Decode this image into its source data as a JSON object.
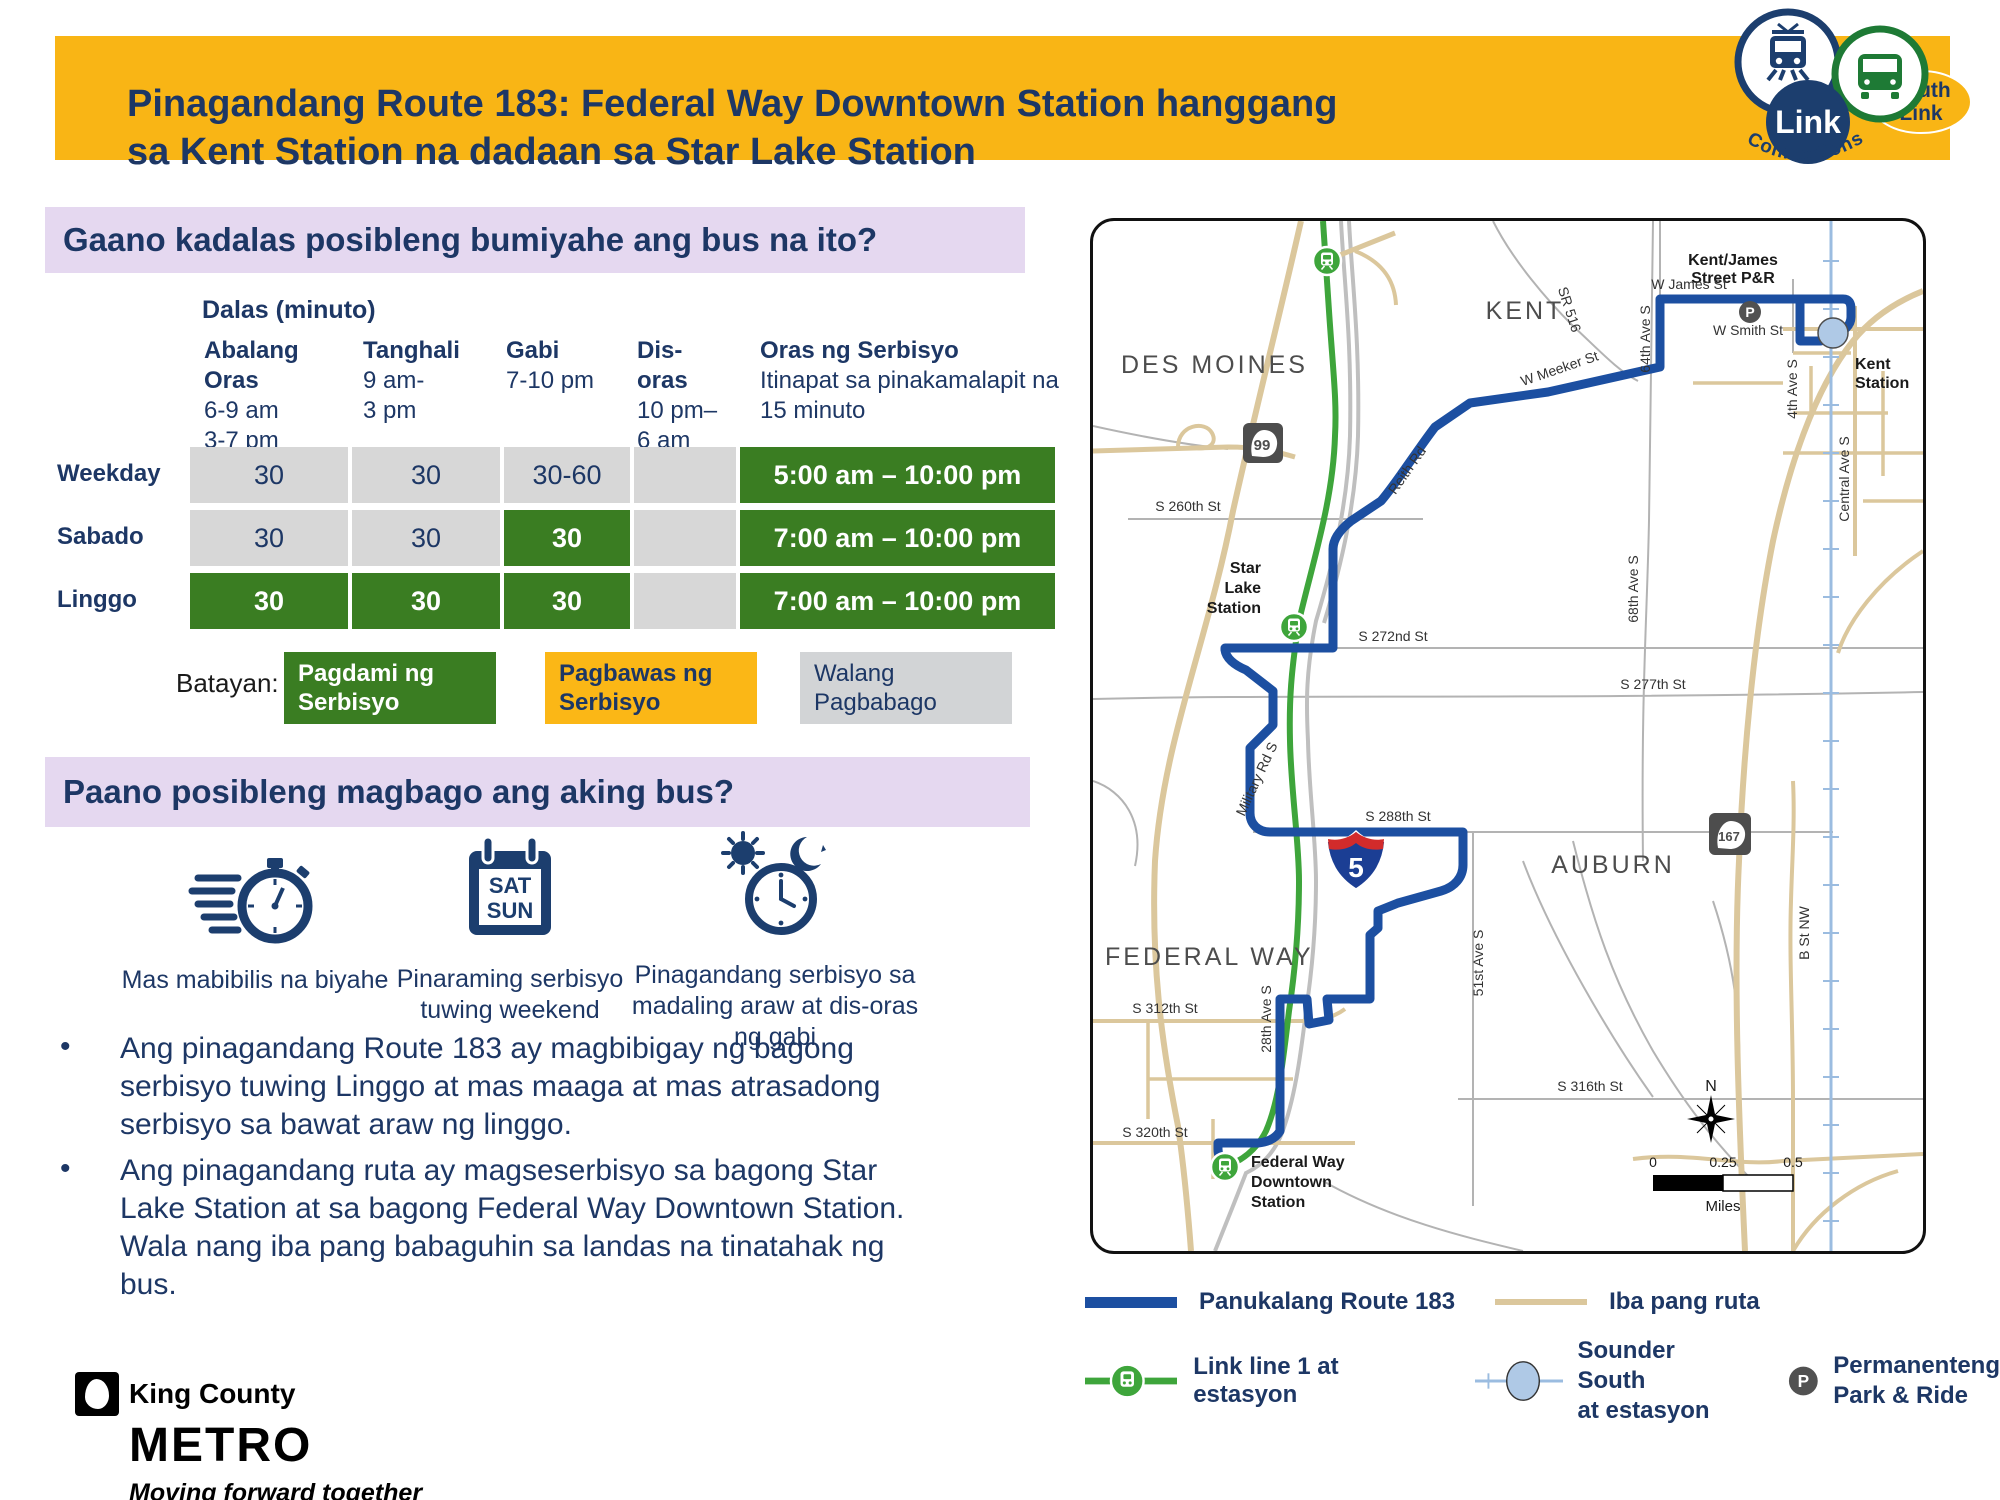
{
  "header": {
    "title_line1": "Pinagandang Route 183: Federal Way Downtown Station hanggang",
    "title_line2": "sa Kent Station na dadaan sa Star Lake Station",
    "logo": {
      "link": "Link",
      "south1": "South",
      "south2": "Link",
      "connections": "Connections"
    }
  },
  "frequency": {
    "heading": "Gaano kadalas posibleng bumiyahe ang bus na ito?",
    "table_label": "Dalas (minuto)",
    "columns": [
      {
        "t1": "Abalang",
        "t2": "Oras",
        "sub": "6-9 am 3-7 pm",
        "sub1": "6-9 am",
        "sub2": "3-7 pm"
      },
      {
        "t1": "Tanghali",
        "t2": "",
        "sub1": "9 am-",
        "sub2": "3 pm"
      },
      {
        "t1": "Gabi",
        "t2": "",
        "sub1": "7-10 pm",
        "sub2": ""
      },
      {
        "t1": "Dis-",
        "t2": "oras",
        "sub1": "10 pm–",
        "sub2": "6 am"
      },
      {
        "t1": "Oras ng Serbisyo",
        "t2": "",
        "sub1": "Itinapat sa pinakamalapit na",
        "sub2": "15 minuto"
      }
    ],
    "rows": [
      {
        "label": "Weekday",
        "c1": "30",
        "c2": "30",
        "c3": "30-60",
        "c4": "",
        "hours": "5:00 am – 10:00 pm"
      },
      {
        "label": "Sabado",
        "c1": "30",
        "c2": "30",
        "c3": "30",
        "c4": "",
        "hours": "7:00 am – 10:00 pm"
      },
      {
        "label": "Linggo",
        "c1": "30",
        "c2": "30",
        "c3": "30",
        "c4": "",
        "hours": "7:00 am – 10:00 pm"
      }
    ],
    "legend": {
      "label": "Batayan:",
      "more": "Pagdami ng Serbisyo",
      "less": "Pagbawas ng Serbisyo",
      "same": "Walang Pagbabago"
    }
  },
  "changes": {
    "heading": "Paano posibleng magbago ang aking bus?",
    "features": [
      {
        "caption": "Mas mabibilis na biyahe"
      },
      {
        "caption": "Pinaraming serbisyo tuwing weekend",
        "cal1": "SAT",
        "cal2": "SUN"
      },
      {
        "caption": "Pinagandang serbisyo sa madaling araw at dis-oras ng gabi"
      }
    ],
    "bullets": [
      "Ang pinagandang Route 183 ay magbibigay ng bagong serbisyo tuwing Linggo at mas maaga at mas atrasadong serbisyo sa bawat araw ng linggo.",
      "Ang pinagandang ruta ay magseserbisyo sa bagong Star Lake Station at sa bagong Federal Way Downtown Station. Wala nang iba pang babaguhin sa landas na tinatahak ng bus."
    ]
  },
  "map": {
    "cities": {
      "des_moines": "DES MOINES",
      "kent": "KENT",
      "auburn": "AUBURN",
      "federal_way": "FEDERAL WAY"
    },
    "labels": {
      "kent_james_1": "Kent/James",
      "kent_james_2": "Street P&R",
      "w_james": "W James St",
      "w_smith": "W Smith St",
      "kent_station_1": "Kent",
      "kent_station_2": "Station",
      "ave_64": "64th Ave S",
      "w_meeker": "W Meeker St",
      "sr516": "SR 516",
      "s260": "S 260th St",
      "reith": "Reith Rd",
      "star_lake_1": "Star",
      "star_lake_2": "Lake",
      "star_lake_3": "Station",
      "s272": "S 272nd St",
      "s277": "S 277th St",
      "ave_68": "68th Ave S",
      "military": "Military Rd S",
      "s288": "S 288th St",
      "ave_51": "51st Ave S",
      "b_st": "B St NW",
      "ave_28": "28th Ave S",
      "s312": "S 312th St",
      "s316": "S 316th St",
      "s320": "S 320th St",
      "fw_station_1": "Federal Way",
      "fw_station_2": "Downtown",
      "fw_station_3": "Station",
      "central": "Central Ave S",
      "ave_4": "4th Ave S",
      "shield99": "99",
      "shield167": "167",
      "i5": "5",
      "p": "P",
      "compass": "N",
      "scale0": "0",
      "scale025": "0.25",
      "scale05": "0.5",
      "miles": "Miles"
    },
    "legend": {
      "route": "Panukalang Route 183",
      "other": "Iba pang ruta",
      "link": "Link line 1 at estasyon",
      "sounder_1": "Sounder South",
      "sounder_2": "at estasyon",
      "parkride_1": "Permanenteng",
      "parkride_2": "Park & Ride",
      "p": "P"
    },
    "colors": {
      "route_blue": "#1c4fa1",
      "link_green": "#3ea53b",
      "other_road": "#dbc79c",
      "sounder": "#9bbce0"
    }
  },
  "footer": {
    "brand_top": "King County",
    "brand_main": "METRO",
    "tagline": "Moving forward together"
  }
}
